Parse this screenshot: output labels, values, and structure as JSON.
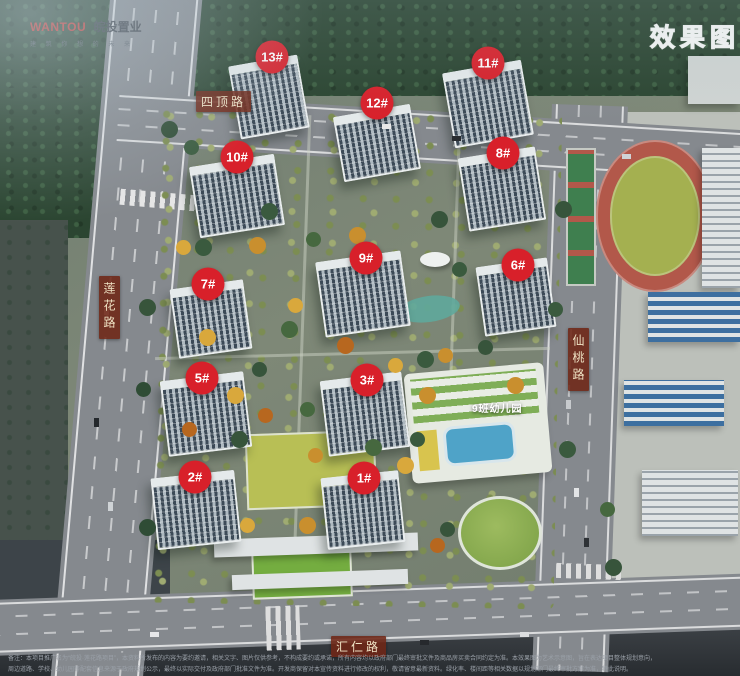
{
  "branding": {
    "logo_en": "WANTOU",
    "logo_cn": "皖投置业",
    "tagline": "建 筑 你 想 的 未 来"
  },
  "corner_tag": "效果图",
  "roads": {
    "top": {
      "name": "四顶路",
      "orientation": "horizontal"
    },
    "left": {
      "name": "莲花路",
      "orientation": "vertical"
    },
    "right": {
      "name": "仙桃路",
      "orientation": "vertical"
    },
    "bottom": {
      "name": "汇仁路",
      "orientation": "horizontal"
    }
  },
  "buildings": [
    {
      "label": "13#",
      "x": 272,
      "y": 57
    },
    {
      "label": "12#",
      "x": 377,
      "y": 103
    },
    {
      "label": "11#",
      "x": 488,
      "y": 63
    },
    {
      "label": "10#",
      "x": 237,
      "y": 157
    },
    {
      "label": "8#",
      "x": 503,
      "y": 153
    },
    {
      "label": "9#",
      "x": 366,
      "y": 258
    },
    {
      "label": "7#",
      "x": 208,
      "y": 284
    },
    {
      "label": "6#",
      "x": 518,
      "y": 265
    },
    {
      "label": "5#",
      "x": 202,
      "y": 378
    },
    {
      "label": "3#",
      "x": 367,
      "y": 380
    },
    {
      "label": "2#",
      "x": 195,
      "y": 477
    },
    {
      "label": "1#",
      "x": 364,
      "y": 478
    }
  ],
  "poi": {
    "kindergarten": "9班幼儿园"
  },
  "disclaimer": {
    "line1": "备注：本项目推广名为“皖投·莲花路项目”，本资料所发布的内容为要约邀请，相关文字、图片仅供参考，不构成要约或承诺，所有内容均以政府部门最终审批文件及商品房买卖合同约定为准。本效果图为艺术示意图，旨在表达项目整体规划意向，",
    "line2": "周边道路、学校、幼儿园等配套信息来源于政府规划公示，最终以实际交付及政府部门批准文件为准。开发商保留对本宣传资料进行修改的权利，敬请留意最新资料。绿化率、楼间距等相关数据以规划部门最终审批方案为准，特此说明。"
  },
  "colors": {
    "marker_red": "#d8202a",
    "road_label_bg": "#6e2616",
    "road_label_text": "#efe2c4",
    "logo_red": "#c8342c"
  }
}
